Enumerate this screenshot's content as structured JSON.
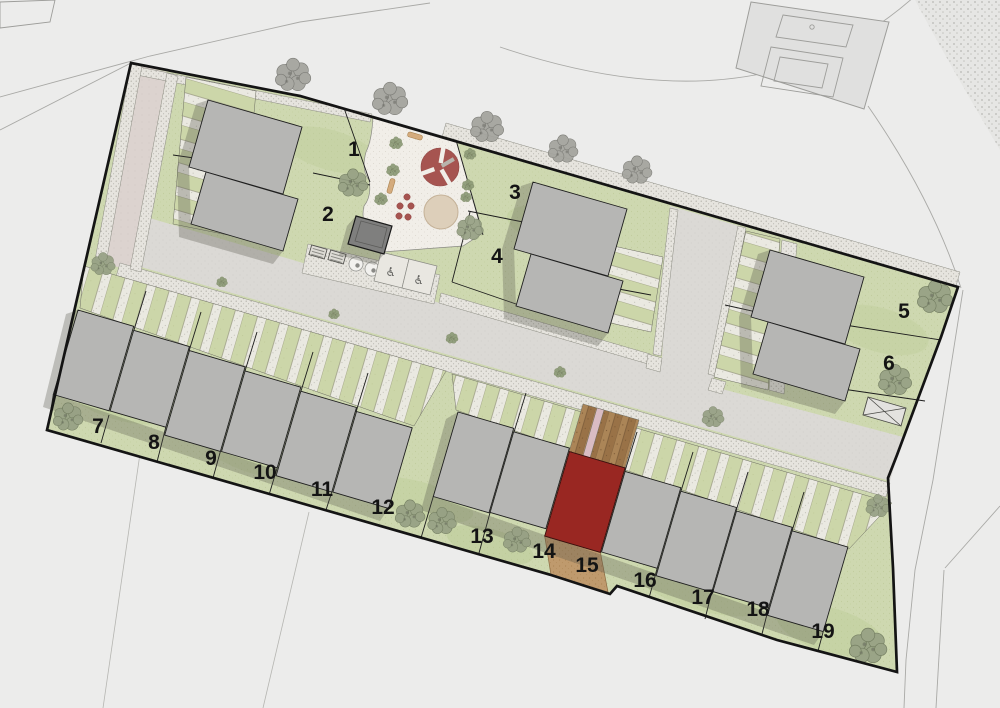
{
  "plan": {
    "type": "residential development site plan",
    "highlighted_plot": "15"
  },
  "plots": [
    {
      "number": "1"
    },
    {
      "number": "2"
    },
    {
      "number": "3"
    },
    {
      "number": "4"
    },
    {
      "number": "5"
    },
    {
      "number": "6"
    },
    {
      "number": "7"
    },
    {
      "number": "8"
    },
    {
      "number": "9"
    },
    {
      "number": "10"
    },
    {
      "number": "11"
    },
    {
      "number": "12"
    },
    {
      "number": "13"
    },
    {
      "number": "14"
    },
    {
      "number": "15"
    },
    {
      "number": "16"
    },
    {
      "number": "17"
    },
    {
      "number": "18"
    },
    {
      "number": "19"
    }
  ],
  "icons": {
    "accessible_parking": "♿"
  },
  "colors": {
    "site_green": "#ced8b0",
    "house_gray": "#b6b6b4",
    "highlight_house": "#992722",
    "highlight_garden": "#bf9a6d",
    "play_equipment": "#a65450",
    "sand_pit": "#ddcfba",
    "boundary": "#141414"
  }
}
